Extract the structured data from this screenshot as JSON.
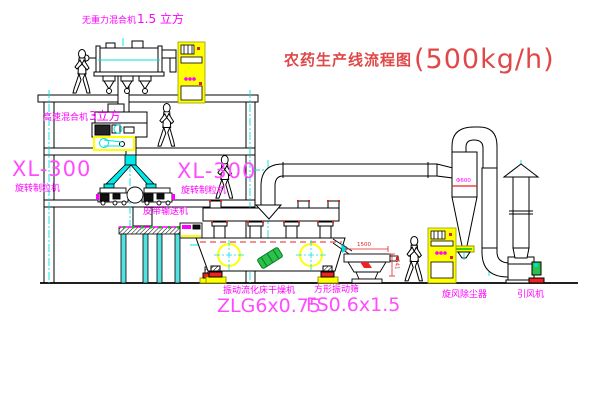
{
  "title": {
    "text": "农药生产线流程图",
    "capacity": "(500kg/h)"
  },
  "equipment_labels": {
    "gravity_mixer": {
      "name": "无重力混合机",
      "volume": "1.5 立方"
    },
    "high_speed_mixer": {
      "name": "高速混合机",
      "volume": "3立方"
    },
    "granulator_left": {
      "model": "XL-300",
      "name": "旋转制粒机"
    },
    "granulator_right": {
      "model": "XL-300",
      "name": "旋转制粒机"
    },
    "belt_conveyor": {
      "name": "皮带输送机"
    },
    "fluid_bed_dryer": {
      "name": "振动流化床干燥机",
      "model": "ZLG6x0.75"
    },
    "vibrating_screen": {
      "name": "方形振动筛",
      "model": "FS0.6x1.5"
    },
    "cyclone": {
      "name": "旋风除尘器",
      "size": "Φ600"
    },
    "fan": {
      "name": "引风机"
    }
  },
  "dimensions": {
    "screen_length": "1500",
    "screen_height": "541"
  },
  "colors": {
    "line": "#000000",
    "centerline": "#00e0e0",
    "label": "#ff00ff",
    "label_light": "#ff4cff",
    "title": "#e04848",
    "cabinet": "#ffff00",
    "accent_red": "#ee2222",
    "accent_green": "#2cc24a",
    "background": "#ffffff"
  }
}
